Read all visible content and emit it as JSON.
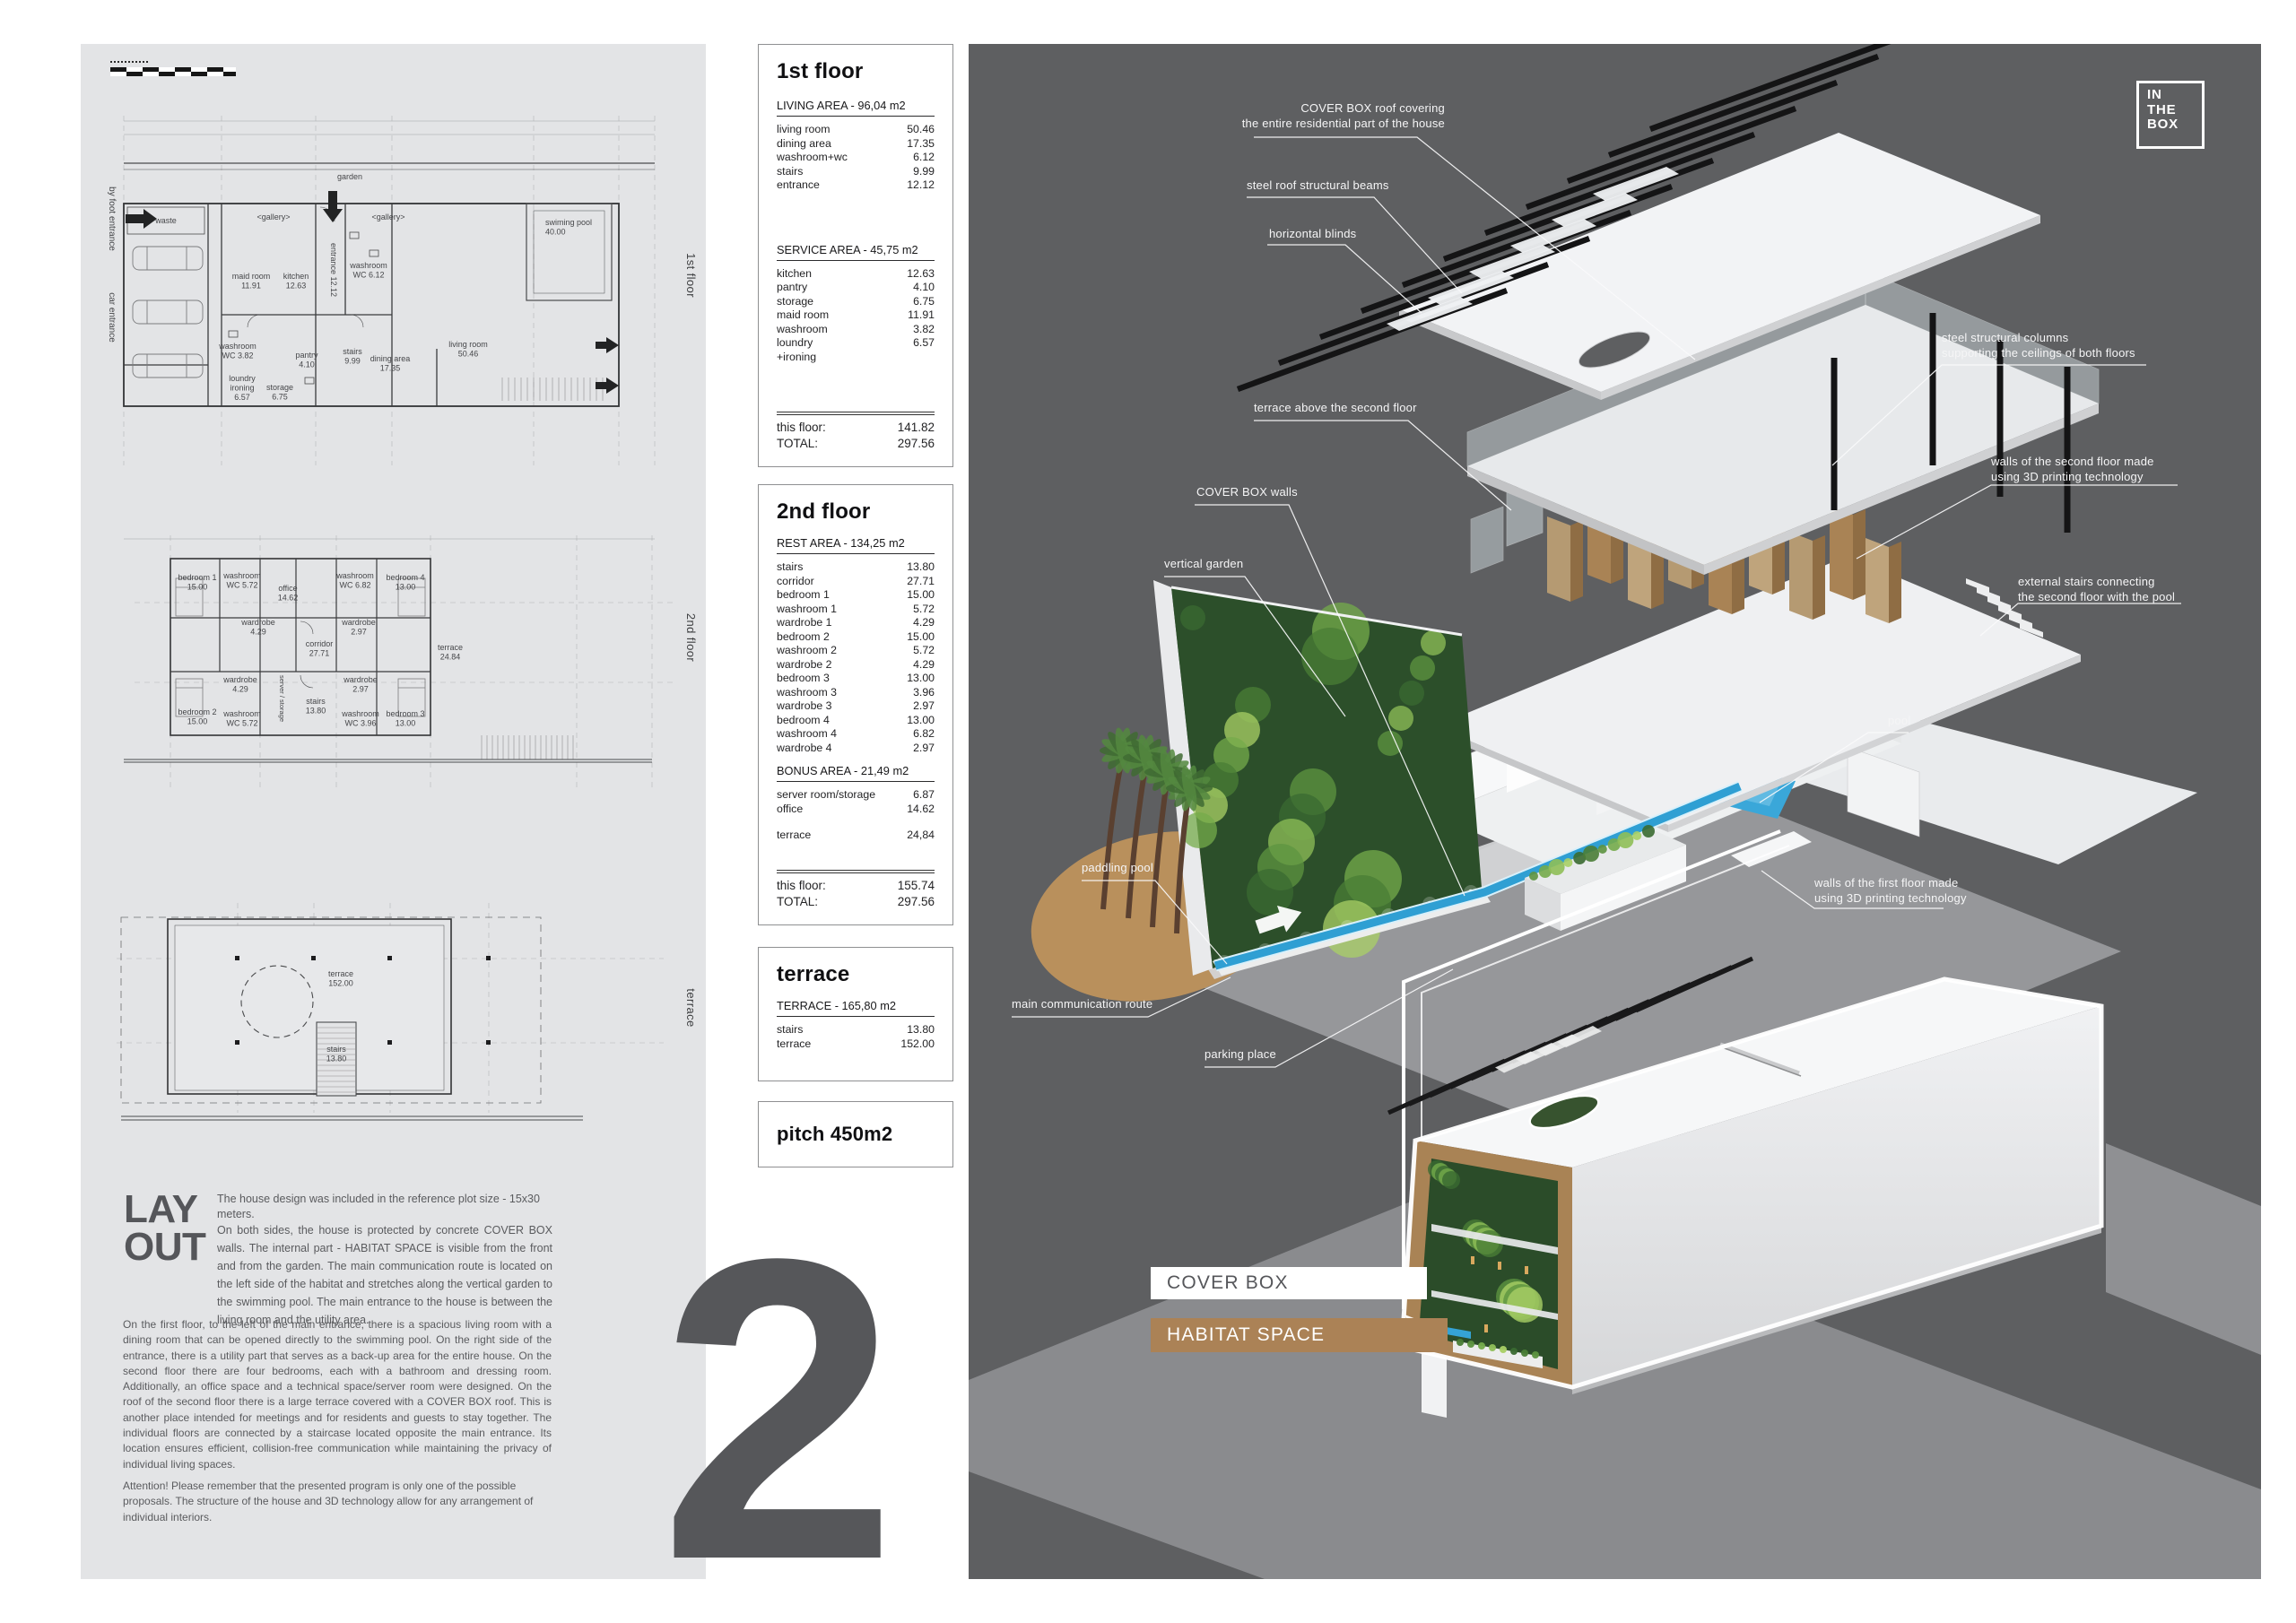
{
  "page": {
    "sheet_number": "2"
  },
  "logo": {
    "line1": "IN",
    "line2": "THE",
    "line3": "BOX"
  },
  "colors": {
    "panel_light": "#e3e4e6",
    "panel_dark": "#5e5f61",
    "accent_brown": "#ab8256",
    "ink": "#58595b",
    "pool_blue": "#3aa7d9",
    "garden_green": "#2c4f2a"
  },
  "plans": {
    "plan1": {
      "side_label": "1st floor",
      "labels": {
        "garden": "garden",
        "gallery1": "<gallery>",
        "gallery2": "<gallery>",
        "pool": "swiming pool\n40.00",
        "waste": "waste",
        "maid": "maid room\n11.91",
        "kitchen": "kitchen\n12.63",
        "entrance": "entrance 12.12",
        "washwc1": "washroom\nWC 6.12",
        "living": "living room\n50.46",
        "dining": "dining area\n17.35",
        "stairs": "stairs\n9.99",
        "pantry": "pantry\n4.10",
        "storage": "storage\n6.75",
        "loundry": "loundry\nironing\n6.57",
        "washwc2": "washroom\nWC 3.82",
        "byfoot": "by foot entrance",
        "car": "car entrance"
      }
    },
    "plan2": {
      "side_label": "2nd floor",
      "labels": {
        "bedroom1": "bedroom 1\n15.00",
        "washroom1": "washroom\nWC 5.72",
        "office": "office\n14.62",
        "washroom4": "washroom\nWC 6.82",
        "bedroom4": "bedroom 4\n13.00",
        "wardrobe1": "wardrobe\n4.29",
        "wardrobe4": "wardrobe\n2.97",
        "corridor": "corridor\n27.71",
        "terrace": "terrace\n24.84",
        "bedroom2": "bedroom 2\n15.00",
        "wardrobe2": "wardrobe\n4.29",
        "server": "server / storage",
        "stairs": "stairs\n13.80",
        "wardrobe3": "wardrobe\n2.97",
        "washroom2": "washroom\nWC 5.72",
        "washroom3": "washroom\nWC 3.96",
        "bedroom3": "bedroom 3\n13.00"
      }
    },
    "plan3": {
      "side_label": "terrace",
      "labels": {
        "terrace": "terrace\n152.00",
        "stairs": "stairs\n13.80"
      }
    }
  },
  "tables": {
    "floor1": {
      "title": "1st floor",
      "sections": [
        {
          "header": "LIVING AREA - 96,04 m2",
          "rows": [
            [
              "living room",
              "50.46"
            ],
            [
              "dining area",
              "17.35"
            ],
            [
              "washroom+wc",
              "6.12"
            ],
            [
              "stairs",
              "9.99"
            ],
            [
              "entrance",
              "12.12"
            ]
          ]
        },
        {
          "header": "SERVICE AREA - 45,75 m2",
          "rows": [
            [
              "kitchen",
              "12.63"
            ],
            [
              "pantry",
              "4.10"
            ],
            [
              "storage",
              "6.75"
            ],
            [
              "maid room",
              "11.91"
            ],
            [
              "washroom",
              "3.82"
            ],
            [
              "loundry\n+ironing",
              "6.57"
            ]
          ]
        }
      ],
      "totals": [
        [
          "this floor:",
          "141.82"
        ],
        [
          "TOTAL:",
          "297.56"
        ]
      ]
    },
    "floor2": {
      "title": "2nd floor",
      "sections": [
        {
          "header": "REST AREA - 134,25 m2",
          "rows": [
            [
              "stairs",
              "13.80"
            ],
            [
              "corridor",
              "27.71"
            ],
            [
              "bedroom 1",
              "15.00"
            ],
            [
              "washroom 1",
              "5.72"
            ],
            [
              "wardrobe 1",
              "4.29"
            ],
            [
              "bedroom 2",
              "15.00"
            ],
            [
              "washroom 2",
              "5.72"
            ],
            [
              "wardrobe 2",
              "4.29"
            ],
            [
              "bedroom 3",
              "13.00"
            ],
            [
              "washroom 3",
              "3.96"
            ],
            [
              "wardrobe 3",
              "2.97"
            ],
            [
              "bedroom 4",
              "13.00"
            ],
            [
              "washroom 4",
              "6.82"
            ],
            [
              "wardrobe 4",
              "2.97"
            ]
          ]
        },
        {
          "header": "BONUS AREA - 21,49 m2",
          "rows": [
            [
              "server room/storage",
              "6.87"
            ],
            [
              "office",
              "14.62"
            ]
          ],
          "late_rows": [
            [
              "terrace",
              "24,84"
            ]
          ]
        }
      ],
      "totals": [
        [
          "this floor:",
          "155.74"
        ],
        [
          "TOTAL:",
          "297.56"
        ]
      ]
    },
    "floor3": {
      "title": "terrace",
      "sections": [
        {
          "header": "TERRACE - 165,80 m2",
          "rows": [
            [
              "stairs",
              "13.80"
            ],
            [
              "terrace",
              "152.00"
            ]
          ]
        }
      ],
      "totals": []
    },
    "pitch": {
      "title": "pitch 450m2"
    }
  },
  "layout_section": {
    "title_line1": "LAY",
    "title_line2": "OUT",
    "para1": "The house design was included in the reference plot size - 15x30 meters.",
    "para2": "On both sides, the house is protected by concrete COVER BOX walls. The internal part - HABITAT SPACE is visible from the front and from the garden. The main communication route is located on the left side of the habitat and stretches along the vertical garden to the swimming pool. The main entrance to the house is between the living room and the utility area.",
    "para3": "On the first floor, to the left of the main entrance, there is a spacious living room with a dining room that can be opened directly to the swimming pool. On the right side of the entrance, there is a utility part that serves as a back-up area for the entire house. On the second floor there are four bedrooms, each with a bathroom and dressing room. Additionally, an office space and a technical space/server room were designed. On the roof of the second floor there is a large terrace covered with a COVER BOX roof. This is another place intended for meetings and for residents and guests to stay together. The individual floors are connected by a staircase located opposite the main entrance. Its location ensures efficient, collision-free communication while maintaining the privacy of individual living spaces.",
    "para4": "Attention! Please remember that the presented program is only one of the possible proposals. The structure of the house and 3D technology allow for any arrangement of individual interiors."
  },
  "annotations": [
    {
      "id": "roof",
      "text": "COVER BOX roof covering\nthe entire residential part of the house"
    },
    {
      "id": "beams",
      "text": "steel roof structural beams"
    },
    {
      "id": "blinds",
      "text": "horizontal blinds"
    },
    {
      "id": "terrace-above",
      "text": "terrace above the second floor"
    },
    {
      "id": "coverbox-walls",
      "text": "COVER BOX walls"
    },
    {
      "id": "vertical-garden",
      "text": "vertical garden"
    },
    {
      "id": "paddling-pool",
      "text": "paddling pool"
    },
    {
      "id": "main-route",
      "text": "main communication route"
    },
    {
      "id": "parking",
      "text": "parking place"
    },
    {
      "id": "columns",
      "text": "steel structural columns\nsupporting the ceilings of both floors"
    },
    {
      "id": "walls-2nd",
      "text": "walls of the second floor made\nusing 3D printing technology"
    },
    {
      "id": "stairs-ext",
      "text": "external stairs connecting\nthe second floor with the pool"
    },
    {
      "id": "pool",
      "text": "pool"
    },
    {
      "id": "walls-1st",
      "text": "walls of the first floor made\nusing 3D printing technology"
    }
  ],
  "render_labels": {
    "cover_box": "COVER BOX",
    "habitat_space": "HABITAT SPACE"
  }
}
